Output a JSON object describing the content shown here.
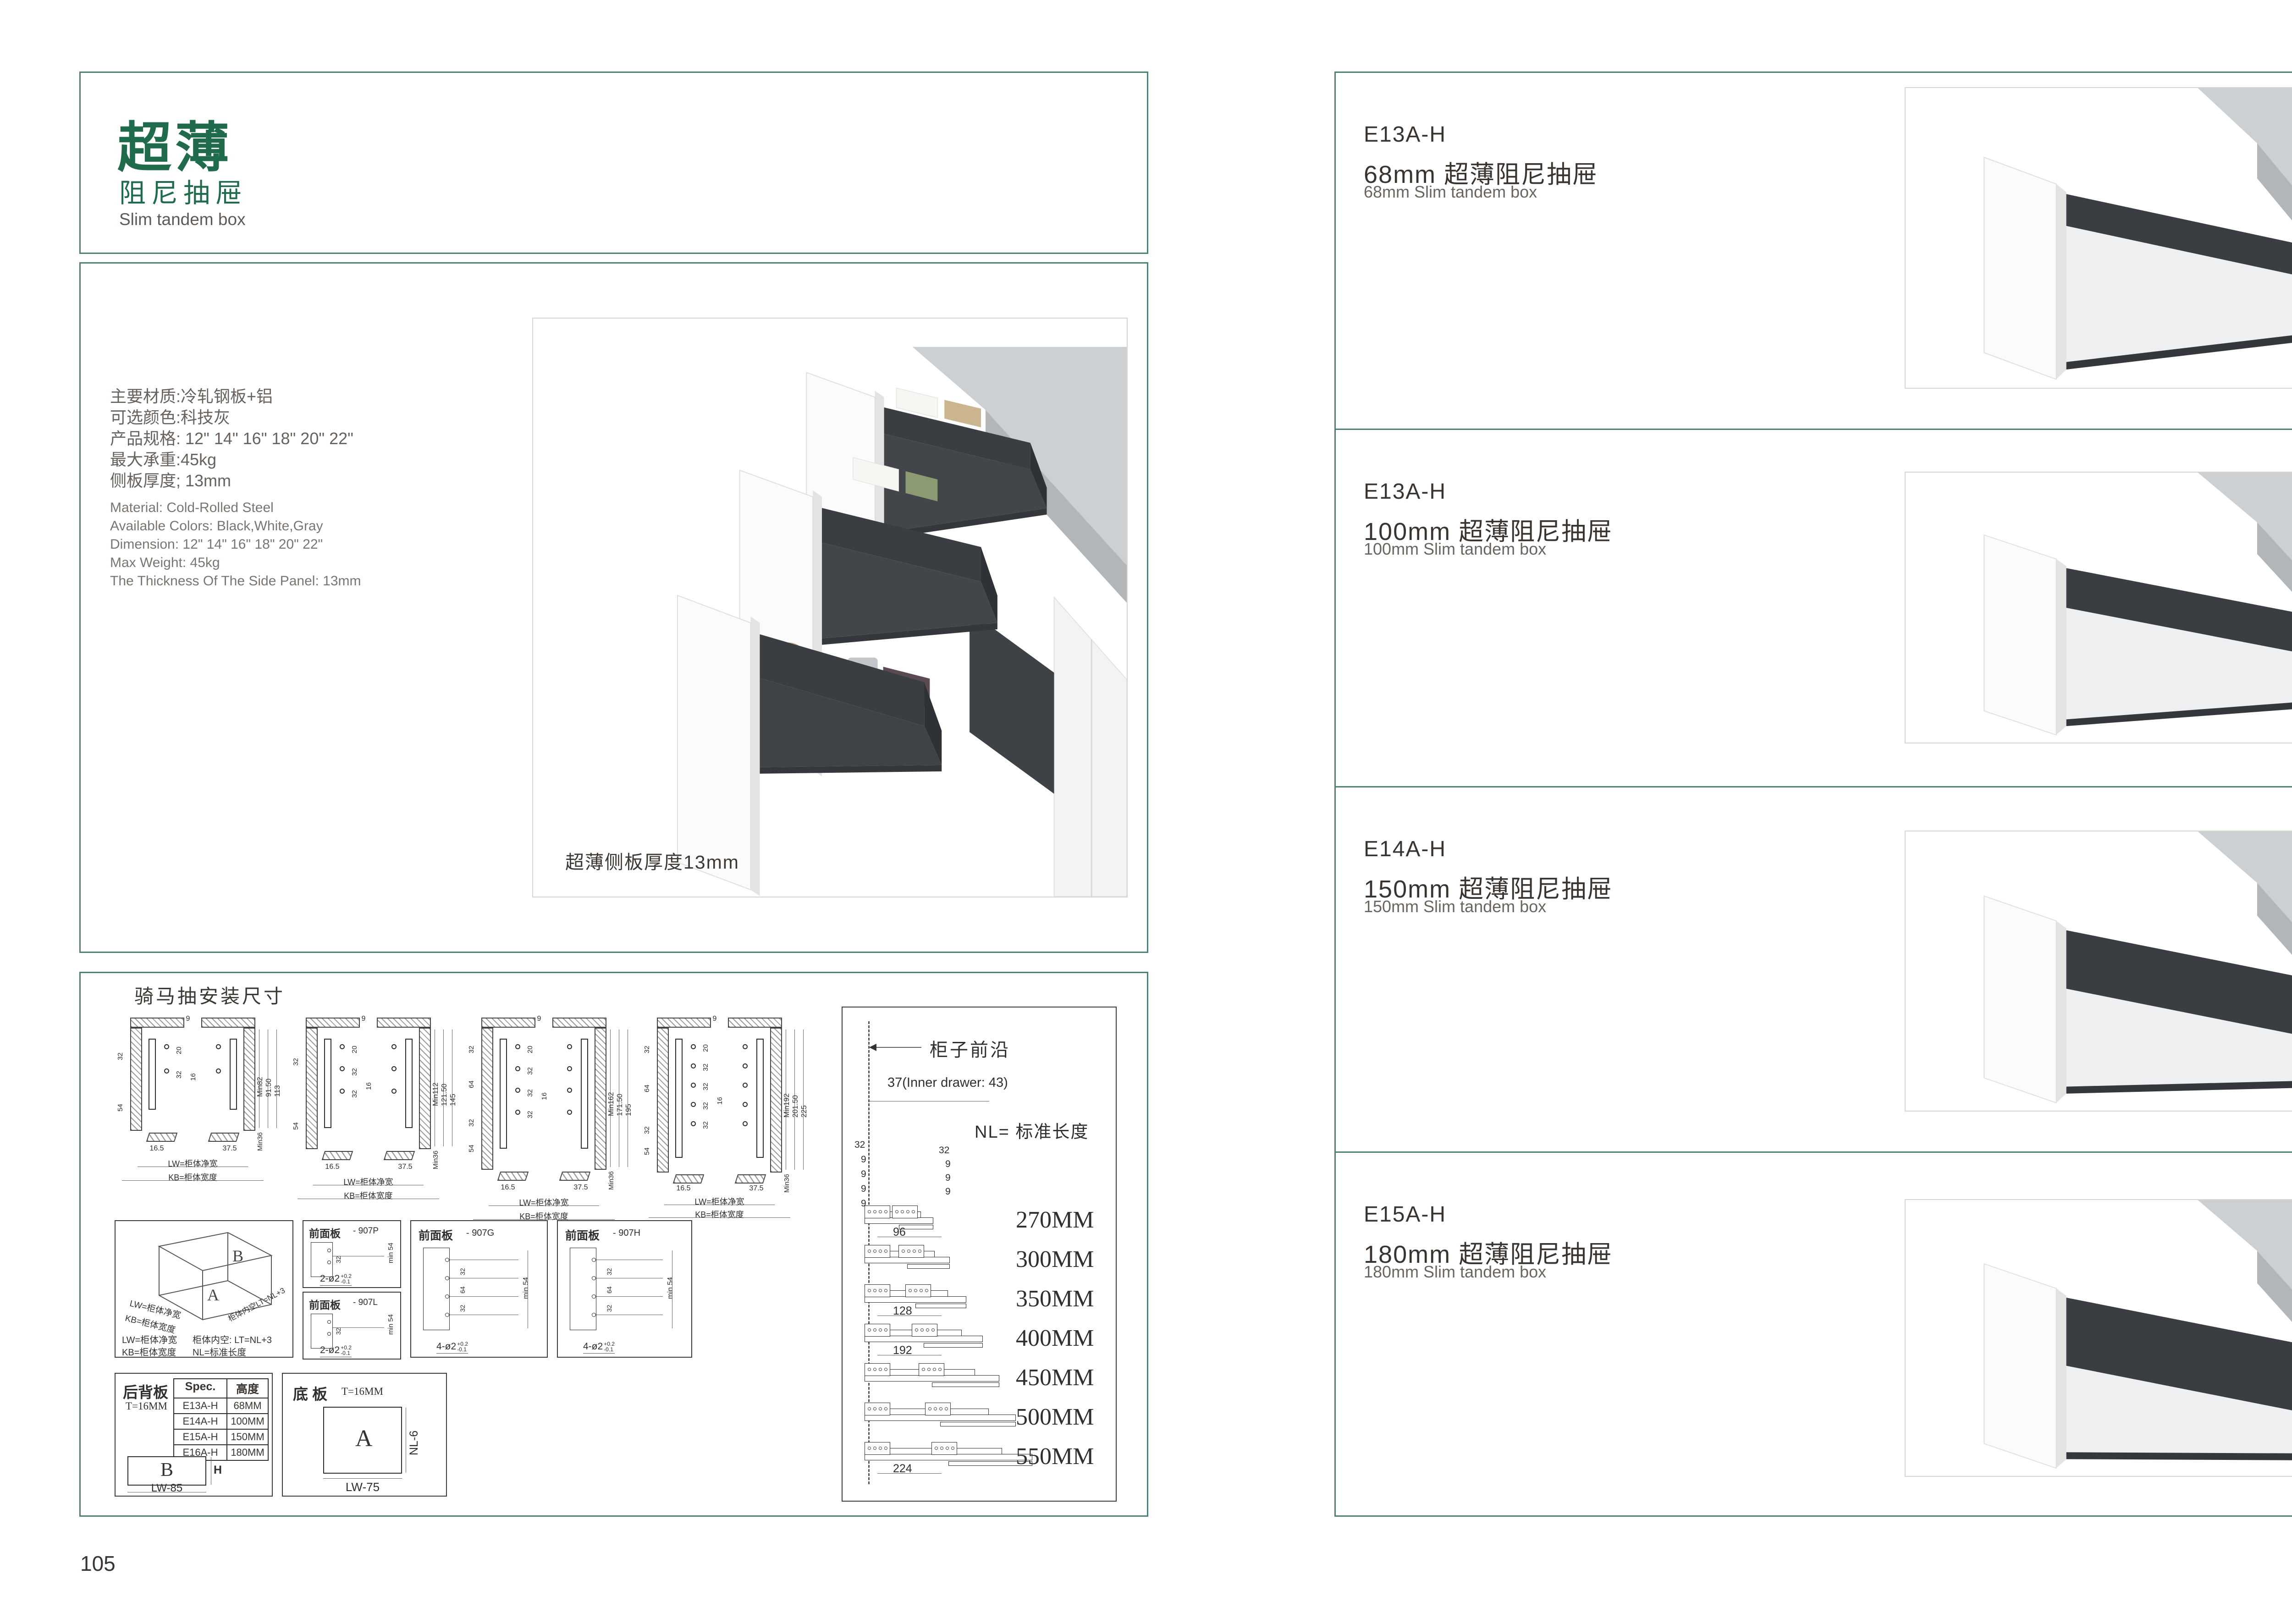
{
  "colors": {
    "accent_teal": "#4d8173",
    "brand_green": "#206b4b",
    "text_dark": "#3a3530",
    "text_gray": "#6f6a65",
    "counter_gray": "#cdd0d2",
    "drawer_dark": "#3a3d42",
    "cabinet_white": "#f3f3f3"
  },
  "page_left": {
    "page_number": "105",
    "header": {
      "title_cn": "超薄",
      "subtitle_cn": "阻尼抽屉",
      "subtitle_en": "Slim tandem box"
    },
    "specs_cn": [
      "主要材质:冷轧钢板+铝",
      "可选颜色:科技灰",
      "产品规格: 12\" 14\" 16\" 18\" 20\" 22\"",
      "最大承重:45kg",
      "侧板厚度; 13mm"
    ],
    "specs_en": [
      "Material: Cold-Rolled Steel",
      "Available Colors: Black,White,Gray",
      "Dimension: 12\" 14\" 16\" 18\" 20\" 22\"",
      "Max Weight: 45kg",
      "The Thickness Of The Side Panel: 13mm"
    ],
    "photo_caption": "超薄侧板厚度13mm",
    "install": {
      "title": "骑马抽安装尺寸",
      "drawings": [
        {
          "top": "9",
          "mid": "16",
          "holes": 2,
          "hole_dims": [
            "20",
            "32"
          ],
          "left_dims": [
            "32",
            "54"
          ],
          "right_dims": [
            "Min82",
            "91.50",
            "113"
          ],
          "corner": "Min36",
          "bottom_dims": [
            "16.5",
            "37.5"
          ],
          "lw": "LW=柜体净宽",
          "kb": "KB=柜体宽度"
        },
        {
          "top": "9",
          "mid": "16",
          "holes": 3,
          "hole_dims": [
            "20",
            "32",
            "32"
          ],
          "left_dims": [
            "32",
            "54"
          ],
          "right_dims": [
            "Min112",
            "121.50",
            "145"
          ],
          "corner": "Min36",
          "bottom_dims": [
            "16.5",
            "37.5"
          ],
          "lw": "LW=柜体净宽",
          "kb": "KB=柜体宽度"
        },
        {
          "top": "9",
          "mid": "16",
          "holes": 4,
          "hole_dims": [
            "20",
            "32",
            "32",
            "32"
          ],
          "left_dims": [
            "32",
            "64",
            "32",
            "54"
          ],
          "right_dims": [
            "Min162",
            "171.50",
            "195"
          ],
          "corner": "Min36",
          "bottom_dims": [
            "16.5",
            "37.5"
          ],
          "lw": "LW=柜体净宽",
          "kb": "KB=柜体宽度"
        },
        {
          "top": "9",
          "mid": "16",
          "holes": 5,
          "hole_dims": [
            "20",
            "32",
            "32",
            "32",
            "32"
          ],
          "left_dims": [
            "32",
            "64",
            "32",
            "54"
          ],
          "right_dims": [
            "Min192",
            "201.50",
            "225"
          ],
          "corner": "Min36",
          "bottom_dims": [
            "16.5",
            "37.5"
          ],
          "lw": "LW=柜体净宽",
          "kb": "KB=柜体宽度"
        }
      ]
    },
    "iso": {
      "letter_a": "A",
      "letter_b": "B",
      "label_lw": "LW=柜体净宽",
      "label_kb": "KB=柜体宽度",
      "label_lt": "柜体内空LT=NL+3",
      "legend": [
        [
          "LW=柜体净宽",
          "柜体内空: LT=NL+3"
        ],
        [
          "KB=柜体宽度",
          "NL=标准长度"
        ]
      ]
    },
    "front_panels": [
      {
        "name": "前面板",
        "code": "- 907P",
        "qty": "2-ø2",
        "tol_up": "+0.2",
        "tol_dn": "-0.1",
        "dims": [
          "32"
        ],
        "min": "min 54"
      },
      {
        "name": "前面板",
        "code": "- 907L",
        "qty": "2-ø2",
        "tol_up": "+0.2",
        "tol_dn": "-0.1",
        "dims": [
          "32"
        ],
        "min": "min 54"
      },
      {
        "name": "前面板",
        "code": "- 907G",
        "qty": "4-ø2",
        "tol_up": "+0.2",
        "tol_dn": "-0.1",
        "dims": [
          "32",
          "64",
          "32"
        ],
        "min": "min 54"
      },
      {
        "name": "前面板",
        "code": "- 907H",
        "qty": "4-ø2",
        "tol_up": "+0.2",
        "tol_dn": "-0.1",
        "dims": [
          "32",
          "64",
          "32"
        ],
        "min": "min 54"
      }
    ],
    "back_panel": {
      "title": "后背板",
      "thickness": "T=16MM",
      "table_headers": [
        "Spec.",
        "高度"
      ],
      "table_rows": [
        [
          "E13A-H",
          "68MM"
        ],
        [
          "E14A-H",
          "100MM"
        ],
        [
          "E15A-H",
          "150MM"
        ],
        [
          "E16A-H",
          "180MM"
        ]
      ],
      "letter": "B",
      "h_label": "H",
      "w_label": "LW-85"
    },
    "bottom_panel": {
      "title": "底 板",
      "thickness": "T=16MM",
      "letter": "A",
      "nl_label": "NL-6",
      "w_label": "LW-75"
    },
    "nl_box": {
      "front_edge": "柜子前沿",
      "offset": "37(Inner drawer: 43)",
      "nl": "NL= 标准长度",
      "small_dims_left": [
        "32",
        "9",
        "9",
        "9",
        "9"
      ],
      "small_dims_right": [
        "32",
        "9",
        "9",
        "9"
      ],
      "row_dims": {
        "0": "96",
        "2": "128",
        "3": "192",
        "6": "224"
      },
      "lengths": [
        "270MM",
        "300MM",
        "350MM",
        "400MM",
        "450MM",
        "500MM",
        "550MM"
      ]
    }
  },
  "page_right": {
    "page_number": "106",
    "sections": [
      {
        "model": "E13A-H",
        "title_cn": "68mm 超薄阻尼抽屉",
        "title_en": "68mm Slim tandem box",
        "height_mm": 68
      },
      {
        "model": "E13A-H",
        "title_cn": "100mm 超薄阻尼抽屉",
        "title_en": "100mm Slim tandem box",
        "height_mm": 100
      },
      {
        "model": "E14A-H",
        "title_cn": "150mm 超薄阻尼抽屉",
        "title_en": "150mm Slim tandem box",
        "height_mm": 150
      },
      {
        "model": "E15A-H",
        "title_cn": "180mm 超薄阻尼抽屉",
        "title_en": "180mm Slim tandem box",
        "height_mm": 180
      }
    ]
  }
}
